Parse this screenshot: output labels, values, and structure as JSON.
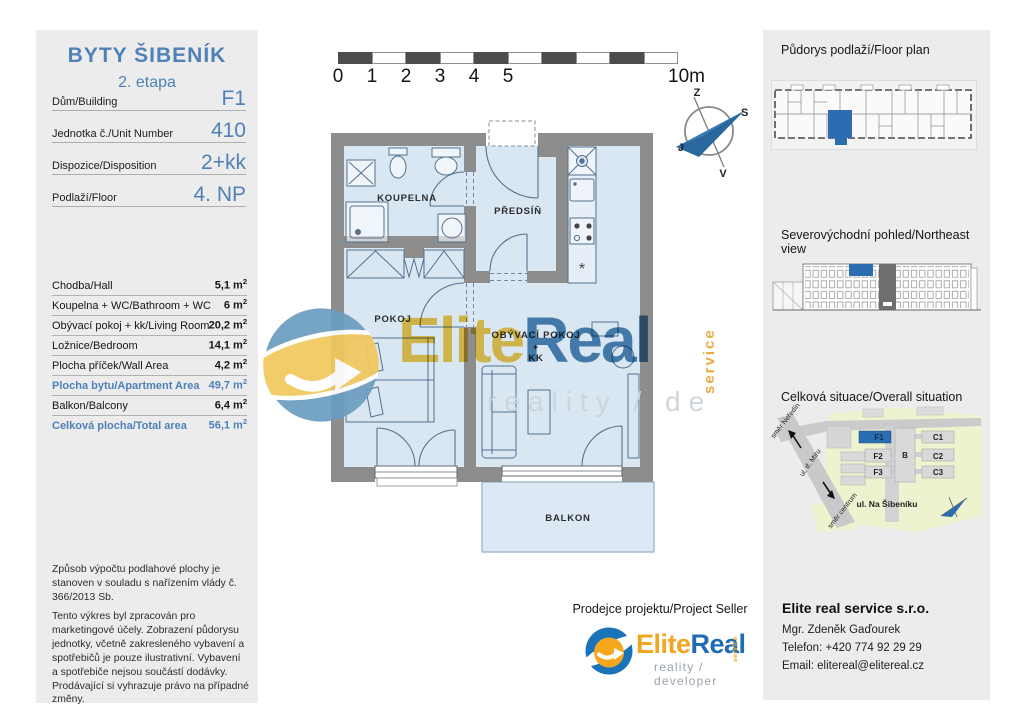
{
  "header": {
    "title": "BYTY ŠIBENÍK",
    "subtitle": "2. etapa",
    "info_rows": [
      {
        "label": "Dům/Building",
        "value": "F1"
      },
      {
        "label": "Jednotka č./Unit Number",
        "value": "410"
      },
      {
        "label": "Dispozice/Disposition",
        "value": "2+kk"
      },
      {
        "label": "Podlaží/Floor",
        "value": "4. NP"
      }
    ]
  },
  "areas": {
    "rows": [
      {
        "label": "Chodba/Hall",
        "value": "5,1 m",
        "sup": "2"
      },
      {
        "label": "Koupelna + WC/Bathroom + WC",
        "value": "6 m",
        "sup": "2"
      },
      {
        "label": "Obývací pokoj + kk/Living Room",
        "value": "20,2 m",
        "sup": "2"
      },
      {
        "label": "Ložnice/Bedroom",
        "value": "14,1 m",
        "sup": "2"
      },
      {
        "label": "Plocha příček/Wall Area",
        "value": "4,2 m",
        "sup": "2"
      },
      {
        "label": "Plocha bytu/Apartment Area",
        "value": "49,7 m",
        "sup": "2"
      },
      {
        "label": "Balkon/Balcony",
        "value": "6,4 m",
        "sup": "2"
      },
      {
        "label": "Celková plocha/Total area",
        "value": "56,1 m",
        "sup": "2"
      }
    ]
  },
  "legal": {
    "para1": "Způsob výpočtu podlahové plochy je stanoven v souladu s nařízením vlády č. 366/2013 Sb.",
    "para2": "Tento výkres byl zpracován pro marketingové účely. Zobrazení půdorysu jednotky, včetně zakresleného vybavení a spotřebičů je pouze ilustrativní. Vybavení a spotřebiče nejsou součástí dodávky. Prodávající si vyhrazuje právo na případné změny."
  },
  "scalebar": {
    "ticks": [
      "0",
      "1",
      "2",
      "3",
      "4",
      "5"
    ],
    "end": "10m"
  },
  "compass": {
    "top": "Z",
    "right": "S",
    "left": "J",
    "bottom": "V"
  },
  "floorplan": {
    "rooms": {
      "bathroom": "KOUPELNA",
      "hall": "PŘEDSÍŇ",
      "bedroom": "POKOJ",
      "living": "OBÝVACÍ POKOJ",
      "living_plus": "+",
      "living_kk": "KK",
      "balcony": "BALKON"
    },
    "symbols": {
      "dishwasher": "*"
    }
  },
  "watermark": {
    "elite": "Elite",
    "real": "Real",
    "service": "service",
    "tagline": "reality / de"
  },
  "sidebar": {
    "floorplan_title": "Půdorys podlaží/Floor plan",
    "view_title": "Severovýchodní pohled/Northeast view",
    "situation_title": "Celková situace/Overall situation",
    "situation": {
      "buildings": [
        "F1",
        "F2",
        "F3",
        "B",
        "C1",
        "C2",
        "C3"
      ],
      "street": "ul. Na Šibeníku",
      "dir_top": "směr Neředín",
      "road": "ul. tř. Míru",
      "dir_bottom": "směr centrum"
    },
    "contact": {
      "company": "Elite real service s.r.o.",
      "person": "Mgr. Zdeněk Gaďourek",
      "phone": "Telefon: +420 774 92 29 29",
      "email": "Email: elitereal@elitereal.cz"
    }
  },
  "seller": {
    "title": "Prodejce projektu/Project Seller",
    "elite": "Elite",
    "real": "Real",
    "service": "service",
    "tagline": "reality / developer"
  },
  "colors": {
    "accent_blue": "#4f81b8",
    "highlight_blue": "#2a6db0",
    "brand_orange": "#efa722",
    "brand_blue": "#1f6cb4",
    "wall_gray": "#8d8d8d",
    "floor_blue": "#d9e7f3"
  }
}
